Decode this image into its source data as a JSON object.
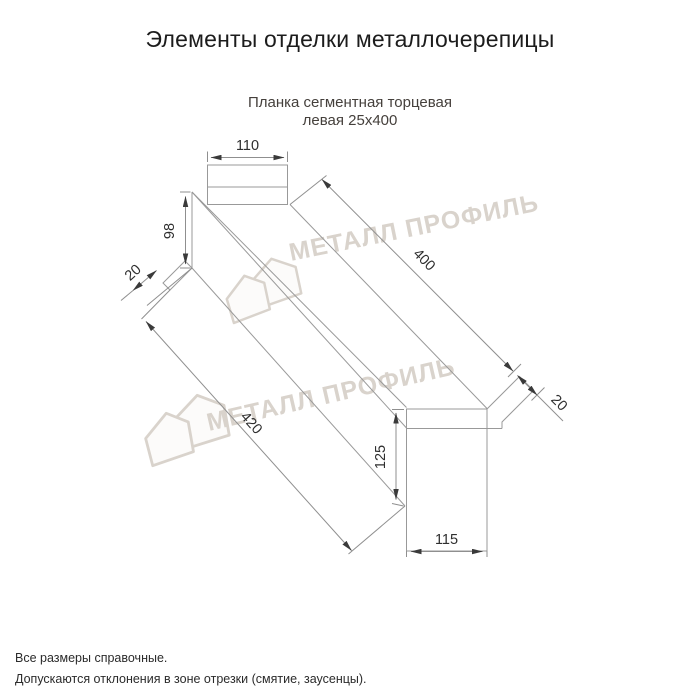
{
  "header": {
    "title": "Элементы отделки металлочерепицы"
  },
  "subtitle": {
    "line1": "Планка сегментная торцевая",
    "line2": "левая 25х400"
  },
  "product": {
    "name": "Планка сегментная торцевая левая",
    "size": "25х400"
  },
  "drawing": {
    "type": "technical-dimension-drawing",
    "dims": {
      "top_flange_width": "110",
      "left_end_height": "98",
      "left_hem": "20",
      "length_top": "400",
      "length_bottom": "420",
      "right_end_height": "125",
      "right_end_width": "115",
      "right_hem": "20"
    }
  },
  "watermark": {
    "text": "МЕТАЛЛ ПРОФИЛЬ",
    "logo": "metall-profil-houses-logo"
  },
  "footer": {
    "note1": "Все размеры справочные.",
    "note2": "Допускаются отклонения в зоне отрезки (смятие, заусенцы)."
  },
  "colors": {
    "line": "#999999",
    "dimension_label": "#2e2e2e",
    "title": "#1c1c1c",
    "subtitle": "#45403c",
    "watermark": "#d9d3cc",
    "background": "#ffffff"
  }
}
